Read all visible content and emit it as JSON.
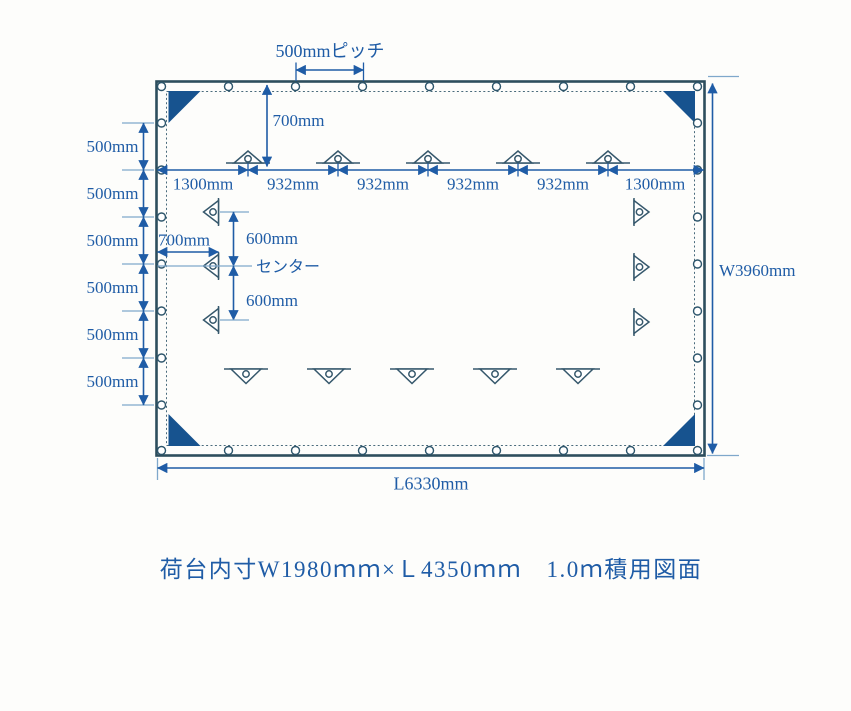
{
  "diagram": {
    "pitch_label": "500mmピッチ",
    "top_offset_label": "700mm",
    "top_dims": [
      "1300mm",
      "932mm",
      "932mm",
      "932mm",
      "932mm",
      "1300mm"
    ],
    "left_dims": [
      "500mm",
      "500mm",
      "500mm",
      "500mm",
      "500mm",
      "500mm"
    ],
    "left_offset_label": "700mm",
    "center_label": "センター",
    "center_dims": [
      "600mm",
      "600mm"
    ],
    "width_label": "W3960mm",
    "length_label": "L6330mm"
  },
  "caption": "荷台内寸W1980ｍｍ×Ｌ4350ｍｍ　1.0ｍ積用図面",
  "colors": {
    "dimension_blue": "#1f5ca6",
    "outline_slate": "#2d4e5d",
    "corner_fill": "#17538f",
    "extension_light_blue": "#7fa8cb",
    "background": "#fdfdfb"
  }
}
